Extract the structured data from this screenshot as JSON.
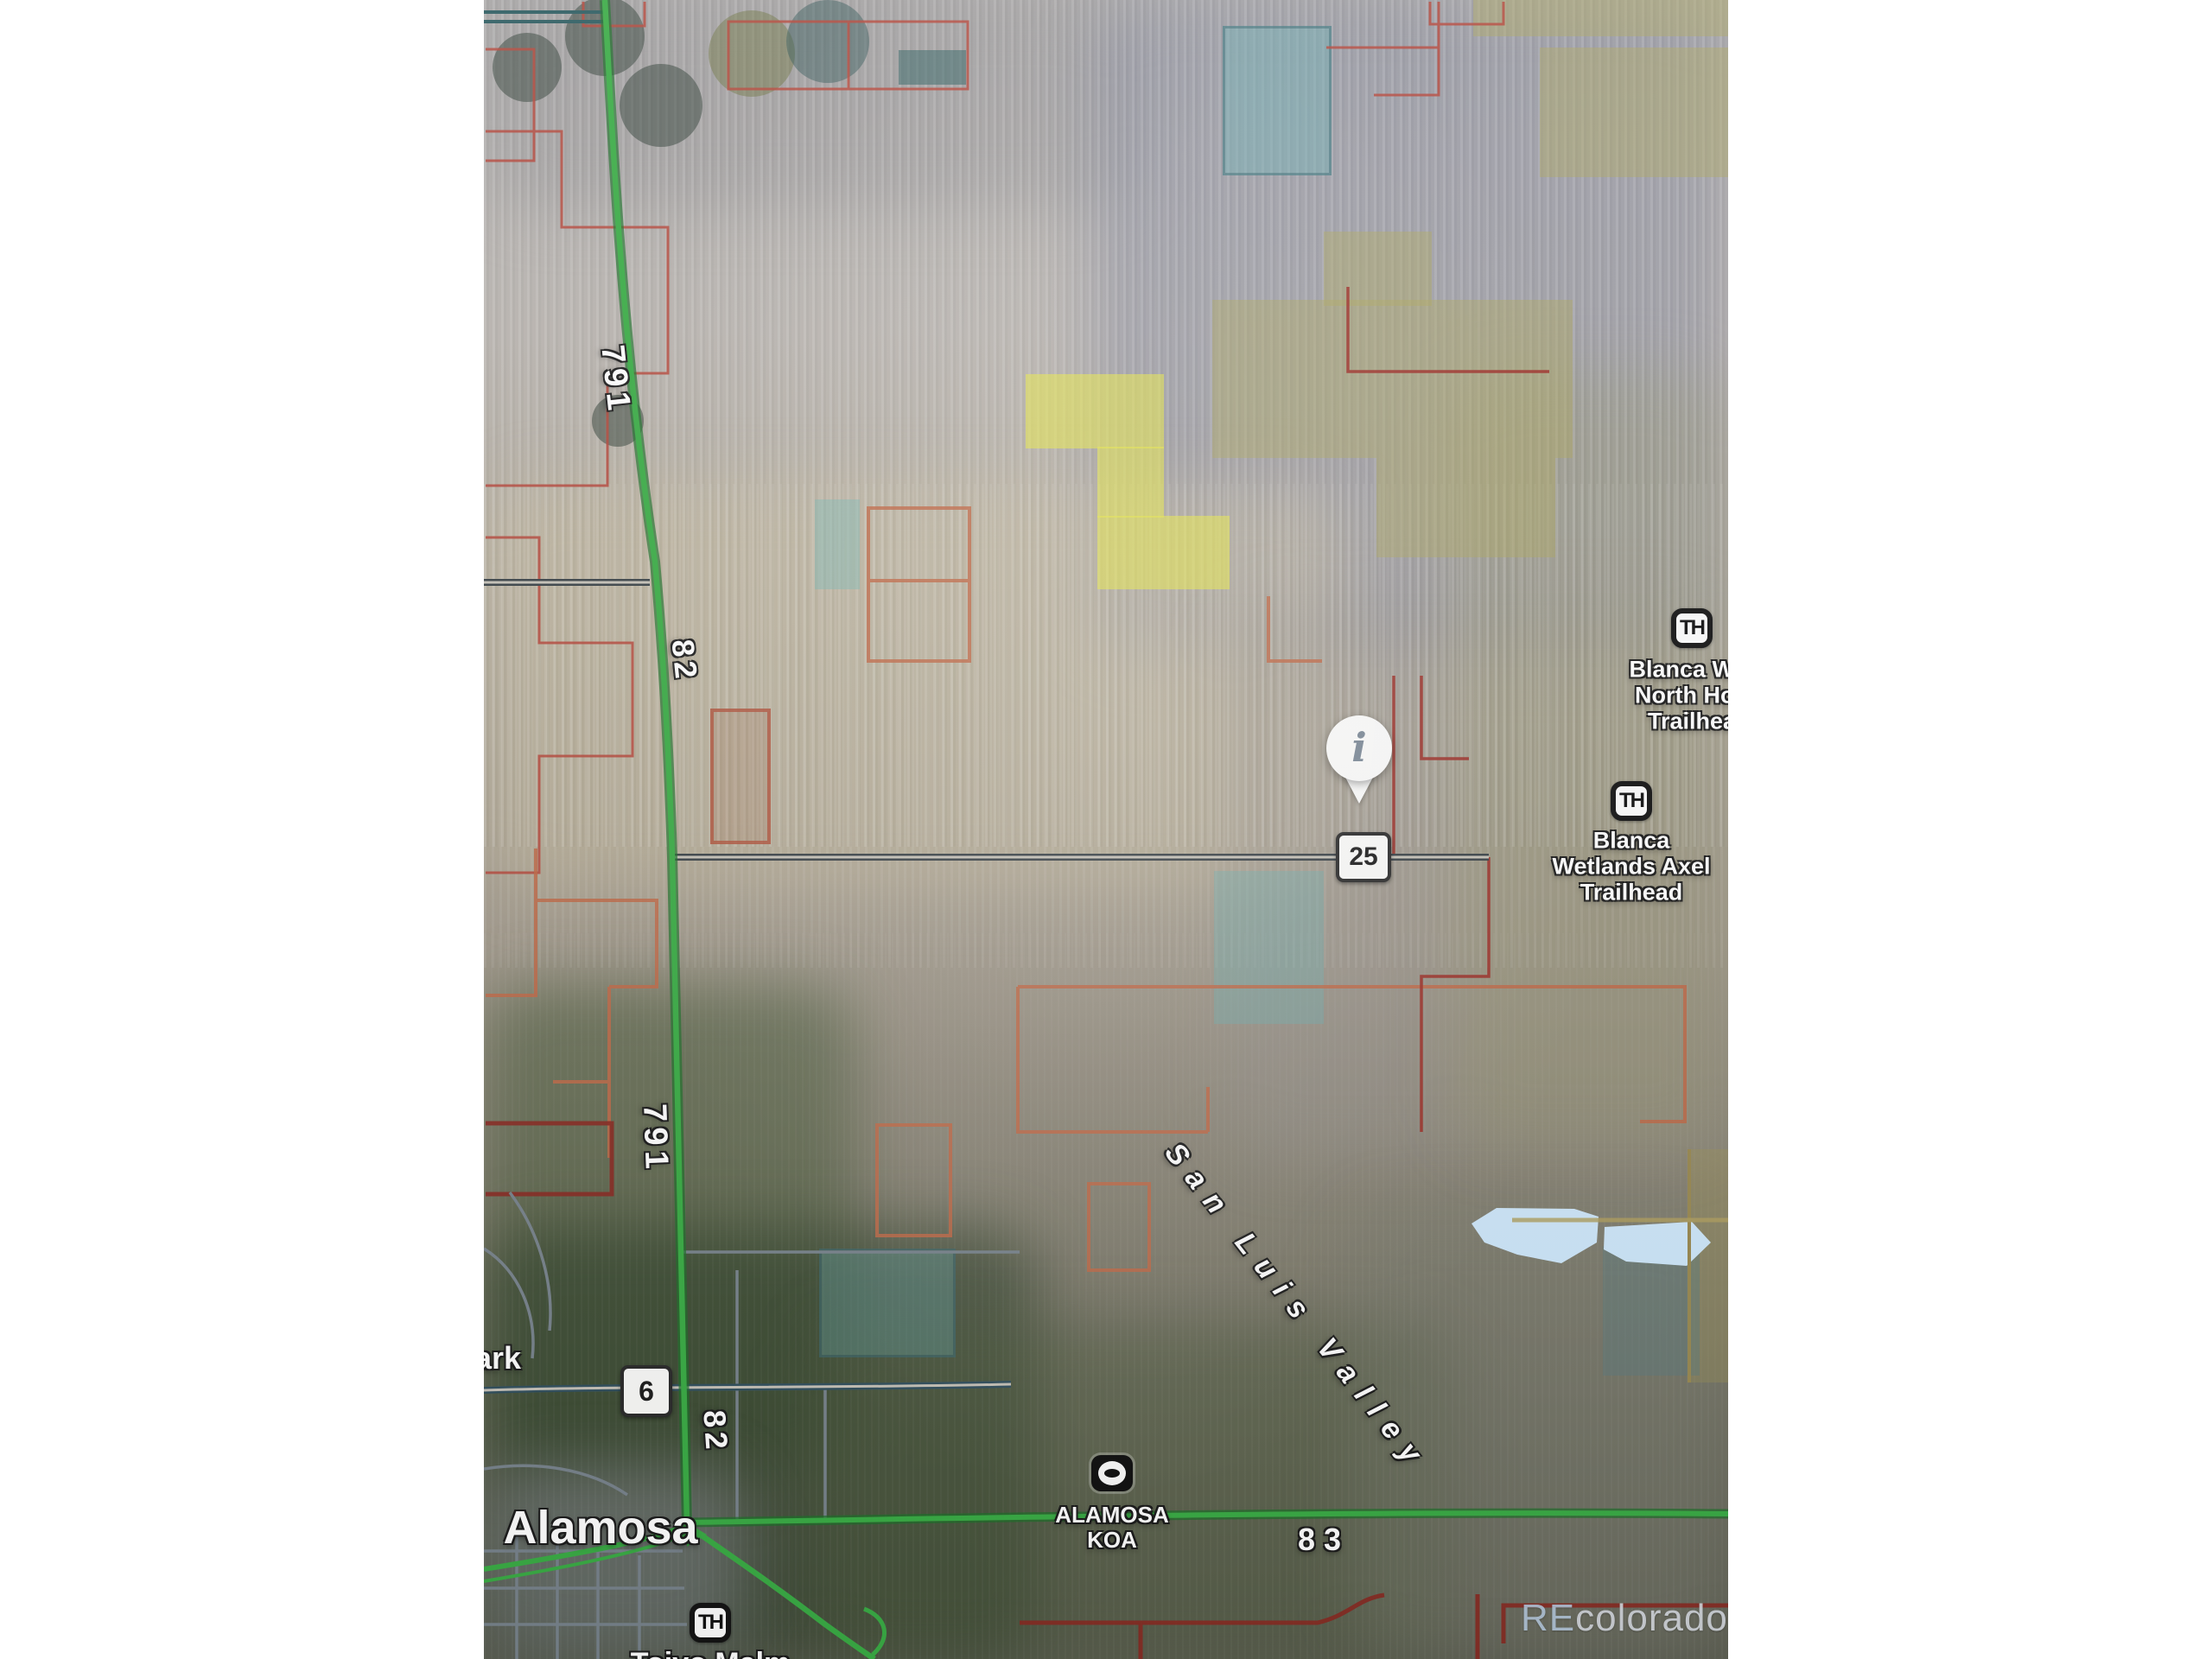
{
  "map": {
    "labels": {
      "road_791_upper": "791",
      "road_82_upper": "82",
      "road_791_lower": "791",
      "road_82_lower": "82",
      "road_25_badge": "25",
      "road_6_badge": "6",
      "road_83": "83",
      "city": "Alamosa",
      "region": "San Luis Valley",
      "park_partial": "ark",
      "koa_line1": "ALAMOSA",
      "koa_line2": "KOA",
      "trailhead_badge": "TH",
      "trailhead1_line1": "Blanca Wet",
      "trailhead1_line2": "North Hon",
      "trailhead1_line3": "Trailhea",
      "trailhead2_line1": "Blanca",
      "trailhead2_line2": "Wetlands Axel",
      "trailhead2_line3": "Trailhead",
      "trailhead3_name": "Toivo Malm",
      "pin_glyph": "i"
    },
    "watermark": {
      "prefix": "RE",
      "suffix": "colorado"
    },
    "colors": {
      "road_green": "#3aac45",
      "road_green_edge": "#1e7029",
      "road_dark": "#3a4247",
      "road_dark_fill": "#c6c2b8",
      "road_blue_dark": "#32505e",
      "street_gray": "#78838c",
      "parcel_red": "#b5463a",
      "parcel_crimson": "#9c3028",
      "parcel_orange": "#c06a48",
      "parcel_darkred": "#8a2a22",
      "overlay_khaki": "rgba(172,166,92,0.45)",
      "overlay_yellow": "rgba(230,230,72,0.60)",
      "overlay_teal": "rgba(108,172,176,0.50)",
      "lake_blue": "#cfe8fb",
      "teal_line": "#2c5b60",
      "label_white": "#ffffff"
    }
  }
}
